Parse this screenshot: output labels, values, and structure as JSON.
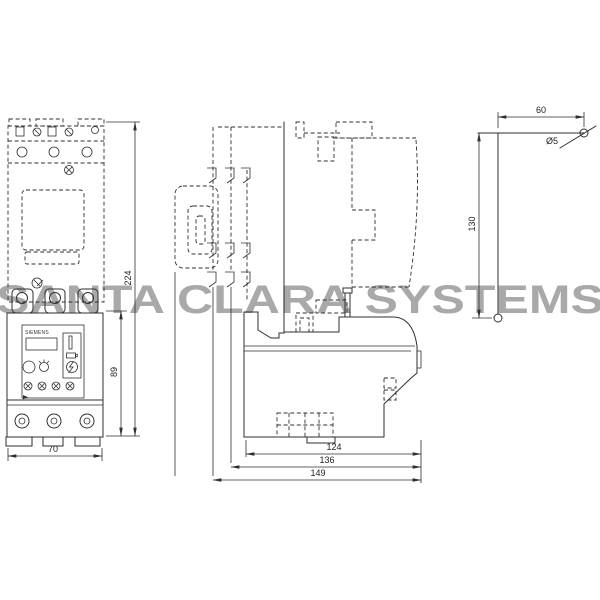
{
  "watermark": {
    "text": "SANTA CLARA SYSTEMS",
    "color": "#a9a9a9"
  },
  "drawing": {
    "type": "technical dimension drawing, three views",
    "brand_label": "SIEMENS",
    "line_color": "#2f2f2f",
    "views": {
      "front": {
        "name": "front view - contactor with overload relay",
        "dims": {
          "overall_height": "224",
          "relay_height": "89",
          "width": "70"
        }
      },
      "side": {
        "name": "side view",
        "dims": {
          "depth_body": "124",
          "depth_mid": "136",
          "depth_overall": "149"
        }
      },
      "reset_rod": {
        "name": "external reset rod detail",
        "dims": {
          "horizontal_offset": "60",
          "vertical_length": "130",
          "rod_diameter": "Ø5"
        }
      }
    }
  }
}
